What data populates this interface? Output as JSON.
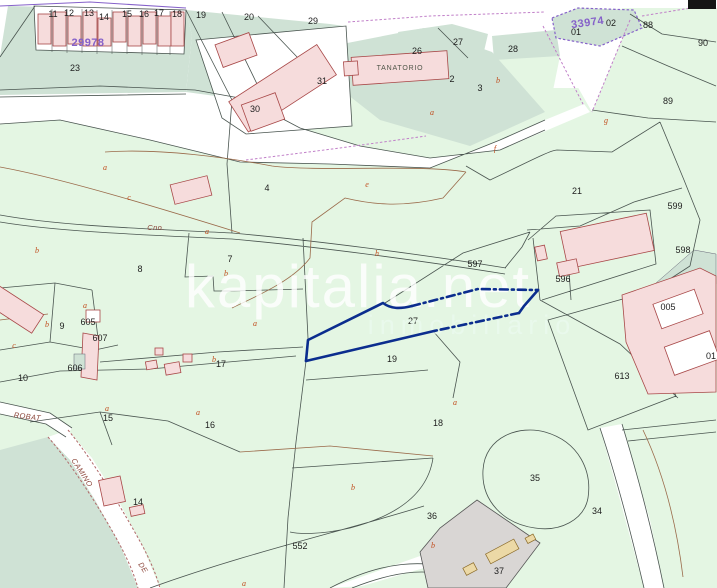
{
  "map": {
    "watermark": {
      "title": "kapitalia.net",
      "subtitle": "inmobiliario"
    },
    "highlighted_parcel": {
      "number": "27",
      "outline_color": "#0b2d8e"
    },
    "cadastral_block_labels": [
      {
        "text": "29978",
        "x": 88,
        "y": 46
      },
      {
        "text": "33974",
        "x": 588,
        "y": 26,
        "rotate": -8
      }
    ],
    "building_labels": [
      {
        "text": "TANATORIO",
        "x": 400,
        "y": 70
      }
    ],
    "place_labels": [
      {
        "text": "Cno.",
        "x": 156,
        "y": 230
      },
      {
        "text": "ROBAT",
        "x": 27,
        "y": 419,
        "rotate": 7
      },
      {
        "text": "CAMINO",
        "x": 80,
        "y": 474,
        "rotate": 57
      },
      {
        "text": "DE",
        "x": 141,
        "y": 569,
        "rotate": 57
      }
    ],
    "parcel_numbers": [
      {
        "text": "11",
        "x": 53,
        "y": 17
      },
      {
        "text": "12",
        "x": 69,
        "y": 16
      },
      {
        "text": "13",
        "x": 89,
        "y": 16
      },
      {
        "text": "14",
        "x": 104,
        "y": 20
      },
      {
        "text": "15",
        "x": 127,
        "y": 17
      },
      {
        "text": "16",
        "x": 144,
        "y": 17
      },
      {
        "text": "17",
        "x": 159,
        "y": 16
      },
      {
        "text": "18",
        "x": 177,
        "y": 17
      },
      {
        "text": "19",
        "x": 201,
        "y": 18
      },
      {
        "text": "20",
        "x": 249,
        "y": 20
      },
      {
        "text": "23",
        "x": 75,
        "y": 71
      },
      {
        "text": "29",
        "x": 313,
        "y": 24
      },
      {
        "text": "31",
        "x": 322,
        "y": 84
      },
      {
        "text": "30",
        "x": 255,
        "y": 112
      },
      {
        "text": "26",
        "x": 417,
        "y": 54
      },
      {
        "text": "27",
        "x": 458,
        "y": 45
      },
      {
        "text": "28",
        "x": 513,
        "y": 52
      },
      {
        "text": "01",
        "x": 576,
        "y": 35
      },
      {
        "text": "02",
        "x": 611,
        "y": 26
      },
      {
        "text": "88",
        "x": 648,
        "y": 28
      },
      {
        "text": "90",
        "x": 703,
        "y": 46
      },
      {
        "text": "89",
        "x": 668,
        "y": 104
      },
      {
        "text": "2",
        "x": 452,
        "y": 82
      },
      {
        "text": "3",
        "x": 480,
        "y": 91
      },
      {
        "text": "4",
        "x": 267,
        "y": 191
      },
      {
        "text": "21",
        "x": 577,
        "y": 194
      },
      {
        "text": "599",
        "x": 675,
        "y": 209
      },
      {
        "text": "598",
        "x": 683,
        "y": 253
      },
      {
        "text": "597",
        "x": 475,
        "y": 267
      },
      {
        "text": "596",
        "x": 563,
        "y": 282
      },
      {
        "text": "7",
        "x": 230,
        "y": 262
      },
      {
        "text": "8",
        "x": 140,
        "y": 272
      },
      {
        "text": "9",
        "x": 62,
        "y": 329
      },
      {
        "text": "605",
        "x": 88,
        "y": 325
      },
      {
        "text": "607",
        "x": 100,
        "y": 341
      },
      {
        "text": "606",
        "x": 75,
        "y": 371
      },
      {
        "text": "10",
        "x": 23,
        "y": 381
      },
      {
        "text": "17",
        "x": 221,
        "y": 367
      },
      {
        "text": "15",
        "x": 108,
        "y": 421
      },
      {
        "text": "16",
        "x": 210,
        "y": 428
      },
      {
        "text": "27",
        "x": 413,
        "y": 324
      },
      {
        "text": "19",
        "x": 392,
        "y": 362
      },
      {
        "text": "18",
        "x": 438,
        "y": 426
      },
      {
        "text": "14",
        "x": 138,
        "y": 505
      },
      {
        "text": "005",
        "x": 668,
        "y": 310
      },
      {
        "text": "01",
        "x": 711,
        "y": 359
      },
      {
        "text": "613",
        "x": 622,
        "y": 379
      },
      {
        "text": "552",
        "x": 300,
        "y": 549
      },
      {
        "text": "36",
        "x": 432,
        "y": 519
      },
      {
        "text": "35",
        "x": 535,
        "y": 481
      },
      {
        "text": "34",
        "x": 597,
        "y": 514
      },
      {
        "text": "37",
        "x": 499,
        "y": 574
      }
    ],
    "subparcel_letters": [
      {
        "text": "a",
        "x": 105,
        "y": 170
      },
      {
        "text": "c",
        "x": 129,
        "y": 200
      },
      {
        "text": "a",
        "x": 207,
        "y": 234
      },
      {
        "text": "b",
        "x": 37,
        "y": 253
      },
      {
        "text": "b",
        "x": 226,
        "y": 276
      },
      {
        "text": "a",
        "x": 85,
        "y": 308
      },
      {
        "text": "b",
        "x": 47,
        "y": 327
      },
      {
        "text": "c",
        "x": 14,
        "y": 348
      },
      {
        "text": "a",
        "x": 255,
        "y": 326
      },
      {
        "text": "b",
        "x": 214,
        "y": 362
      },
      {
        "text": "a",
        "x": 107,
        "y": 411
      },
      {
        "text": "a",
        "x": 198,
        "y": 415
      },
      {
        "text": "a",
        "x": 432,
        "y": 115
      },
      {
        "text": "b",
        "x": 498,
        "y": 83
      },
      {
        "text": "g",
        "x": 606,
        "y": 123
      },
      {
        "text": "f",
        "x": 495,
        "y": 151
      },
      {
        "text": "e",
        "x": 367,
        "y": 187
      },
      {
        "text": "h",
        "x": 377,
        "y": 256
      },
      {
        "text": "a",
        "x": 455,
        "y": 405
      },
      {
        "text": "b",
        "x": 353,
        "y": 490
      },
      {
        "text": "b",
        "x": 433,
        "y": 548
      },
      {
        "text": "a",
        "x": 244,
        "y": 586
      }
    ],
    "colors": {
      "parcel_green": "#e4f6e3",
      "urban_teal": "#cfe2d5",
      "building_pink": "#f6dcdc",
      "building_outline": "#a84848",
      "boundary": "#4a5550",
      "subparcel_brown": "#9a6a4a",
      "cadastral_purple": "#8561c9",
      "highlight_blue": "#0b2d8e",
      "place_label_red": "#8a4438",
      "letter_orange": "#c04a1a",
      "parcel37_gray": "#d9d6d4",
      "shed_tan": "#ecd9a6"
    }
  }
}
